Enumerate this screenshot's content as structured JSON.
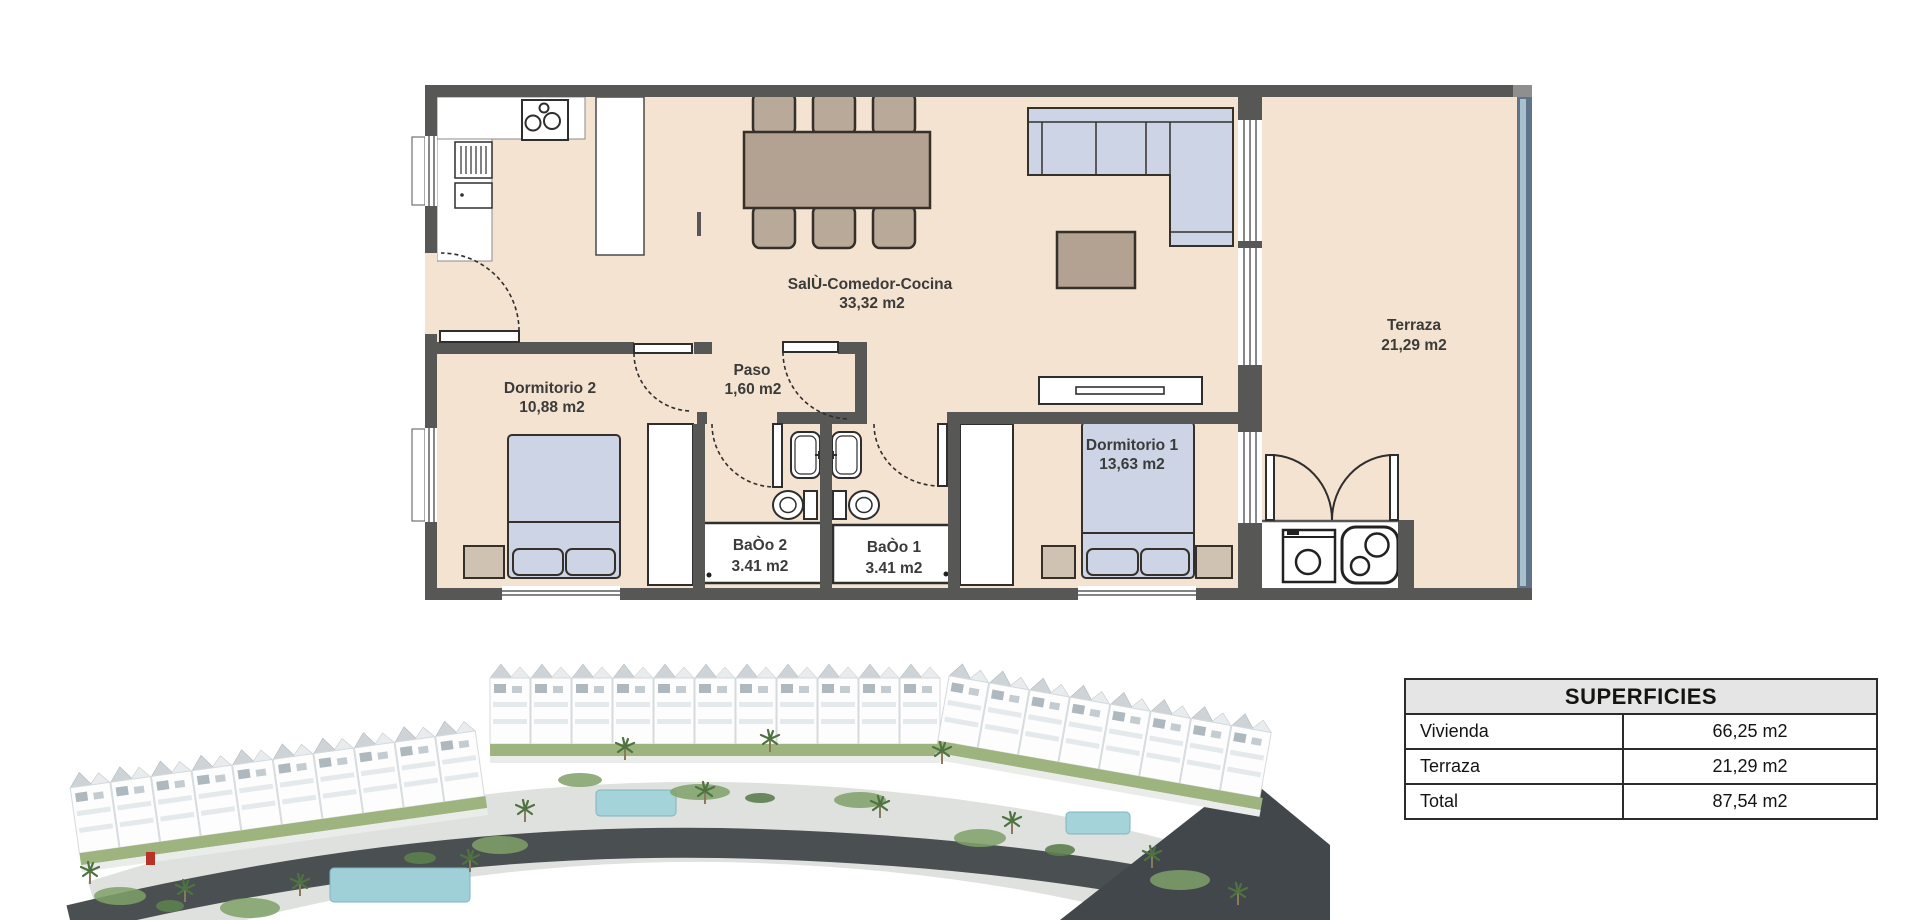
{
  "floor_plan": {
    "rooms": [
      {
        "id": "salon",
        "name": "SalÙ-Comedor-Cocina",
        "area": "33,32 m2"
      },
      {
        "id": "terraza",
        "name": "Terraza",
        "area": "21,29 m2"
      },
      {
        "id": "dormitorio2",
        "name": "Dormitorio 2",
        "area": "10,88 m2"
      },
      {
        "id": "paso",
        "name": "Paso",
        "area": "1,60 m2"
      },
      {
        "id": "dormitorio1",
        "name": "Dormitorio 1",
        "area": "13,63 m2"
      },
      {
        "id": "bano2",
        "name": "BaÒo 2",
        "area": "3.41 m2"
      },
      {
        "id": "bano1",
        "name": "BaÒo 1",
        "area": "3.41 m2"
      }
    ]
  },
  "superficies_table": {
    "title": "SUPERFICIES",
    "rows": [
      {
        "label": "Vivienda",
        "value": "66,25 m2"
      },
      {
        "label": "Terraza",
        "value": "21,29 m2"
      },
      {
        "label": "Total",
        "value": "87,54 m2"
      }
    ]
  },
  "colors": {
    "wall": "#575756",
    "floor": "#f4e3d0",
    "furniture_blue": "#cdd4e6",
    "furniture_wood": "#b3a191",
    "glass_wall": "#5f7488",
    "glass_wall_light": "#a9c0cf",
    "table_header_bg": "#e5e5e5",
    "road_dark": "#4a5052",
    "greenery": "#7fa168",
    "pool": "#9fd0d8",
    "accent_red": "#b83226"
  }
}
